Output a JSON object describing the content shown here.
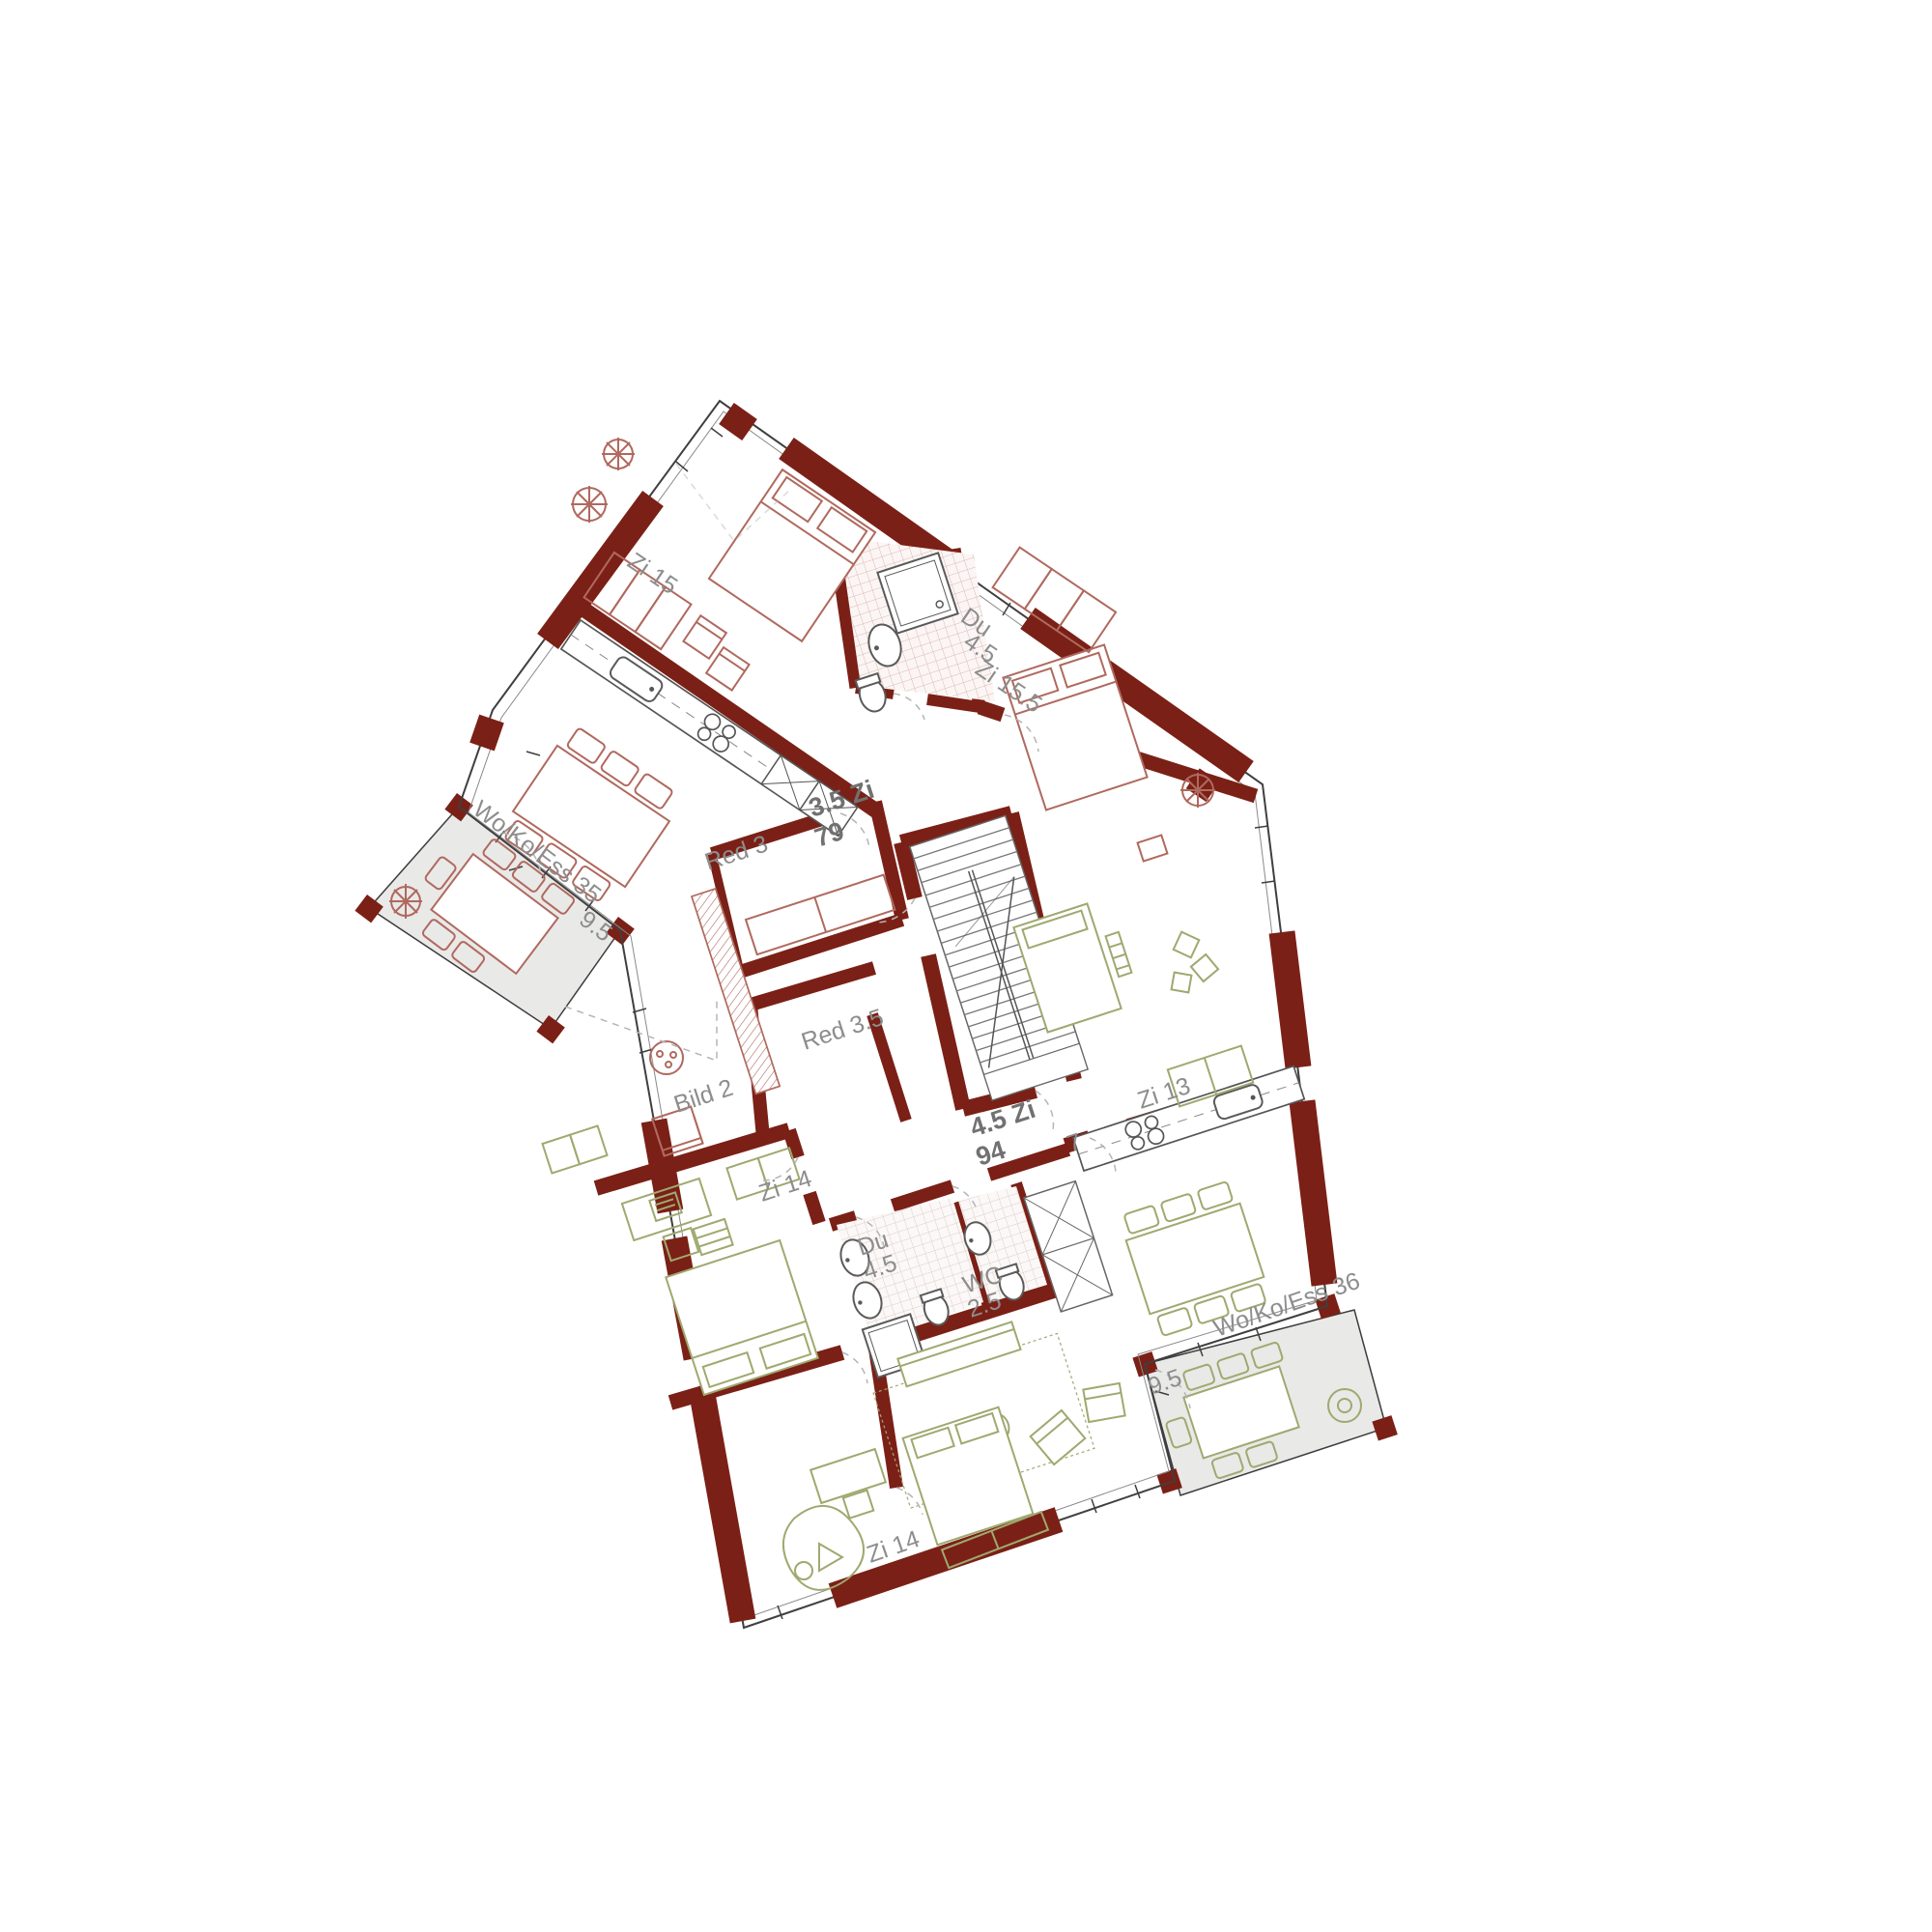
{
  "floor_plan": {
    "type": "residential floor plan",
    "apartments": [
      {
        "name": "3.5 Zi",
        "area_m2": "79",
        "accent_color": "#b0695e",
        "rooms": [
          {
            "name": "Zi 15"
          },
          {
            "name": "Du",
            "area": "4.5"
          },
          {
            "name": "Zi 15.5"
          },
          {
            "name": "Wo/Ko/Ess 35"
          },
          {
            "name": "Red 3"
          },
          {
            "name": "Balkon",
            "area": "9.5"
          }
        ]
      },
      {
        "name": "4.5 Zi",
        "area_m2": "94",
        "accent_color": "#9fa96f",
        "rooms": [
          {
            "name": "Zi 13"
          },
          {
            "name": "Zi 14"
          },
          {
            "name": "Zi 14"
          },
          {
            "name": "Red 3.5"
          },
          {
            "name": "Du",
            "area": "4.5"
          },
          {
            "name": "WC",
            "area": "2.5"
          },
          {
            "name": "Wo/Ko/Ess 36"
          },
          {
            "name": "Korridor",
            "area": "7"
          },
          {
            "name": "Balkon",
            "area": "9.5"
          }
        ]
      }
    ],
    "annotations": [
      {
        "name": "Bild 2"
      }
    ]
  },
  "labels": {
    "zi15": "Zi 15",
    "du35_name": "Du",
    "du35_area": "4.5",
    "zi155": "Zi 15.5",
    "wokoess35": "Wo/Ko/Ess 35",
    "balcony35_area": "9.5",
    "apt35_name": "3.5 Zi",
    "apt35_area": "79",
    "red3": "Red 3",
    "red35": "Red 3.5",
    "bild2": "Bild 2",
    "zi14_mid": "Zi 14",
    "apt45_name": "4.5 Zi",
    "apt45_area": "94",
    "corridor45_area": "7",
    "zi13": "Zi 13",
    "du45_name": "Du",
    "du45_area": "4.5",
    "wc_name": "WC",
    "wc_area": "2.5",
    "wokoess36": "Wo/Ko/Ess 36",
    "balcony36_area": "9.5",
    "zi14_bottom": "Zi 14"
  },
  "colors": {
    "wall": "#7b2016",
    "furniture_upper": "#b0695e",
    "furniture_lower": "#9fa96f",
    "balcony_fill": "#e9e9e8",
    "label_text": "#8d8d8d",
    "bold_label_text": "#717171"
  }
}
